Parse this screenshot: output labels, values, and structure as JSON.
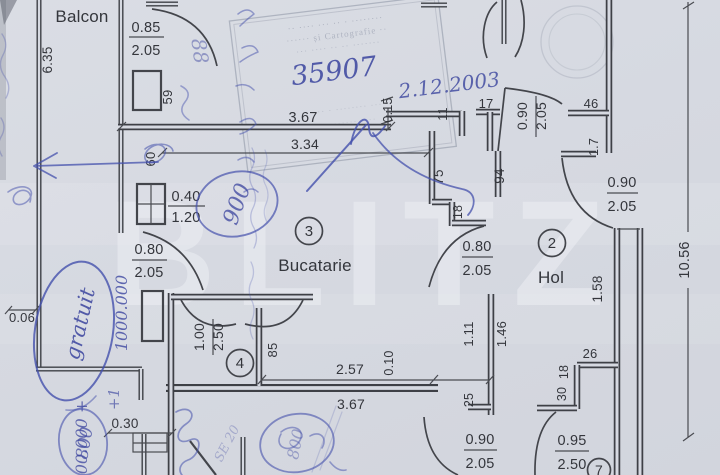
{
  "colors": {
    "paper": "#d6d9e1",
    "ink": "#3b3d43",
    "pen_blue": "#4450ac"
  },
  "watermark": "BLITZ",
  "rooms": {
    "balcony_label": "Balcon",
    "kitchen_no": "3",
    "kitchen_label": "Bucatarie",
    "hall_no": "2",
    "hall_label": "Hol",
    "storage_no": "4",
    "room7_no": "7"
  },
  "doors": {
    "balcony_door": {
      "w": "0.85",
      "h": "2.05"
    },
    "kitchen_window": {
      "w": "0.40",
      "h": "1.20"
    },
    "balcony_lower_door": {
      "w": "0.80",
      "h": "2.05"
    },
    "kitchen_hall_door": {
      "w": "0.80",
      "h": "2.05"
    },
    "entry_door": {
      "w": "0.90",
      "h": "2.05"
    },
    "hall_right_door": {
      "w": "0.90",
      "h": "2.05"
    },
    "storage_door": {
      "w": "1.00",
      "h": "2.50"
    },
    "bottom_door": {
      "w": "0.90",
      "h": "2.05"
    },
    "bottom_right_door": {
      "w": "0.95",
      "h": "2.50"
    }
  },
  "dims": {
    "balcony_len": "6.35",
    "pier": "59",
    "kitchen_out": "3.67",
    "step015": "0.15",
    "n11": "11",
    "n17": "17",
    "n46": "46",
    "n17b": "1.7",
    "kitchen_in": "3.34",
    "n60": "60",
    "n75": "75",
    "n94": "94",
    "n18": "18",
    "n18b": "18",
    "hall_total": "10.56",
    "n158": "1.58",
    "n85": "85",
    "n257": "2.57",
    "n010": "0.10",
    "bottom": "3.67",
    "n111": "1.11",
    "n146": "1.46",
    "n25": "25",
    "n26": "26",
    "n30": "30",
    "n006": "0.06",
    "n030": "0.30"
  },
  "stamp": {
    "number": "35907",
    "date": "2.12.2003",
    "rows": [
      "·· ···· ··· ·· · ········",
      "······ și Cartografie ··",
      "··· ···· ·· ·· ·······",
      "···· · ········ ···",
      "·· ······· ····"
    ]
  },
  "pen": {
    "gratuit": "gratuit",
    "amount_1": "1000.000",
    "amount_2": "00.000 +",
    "plus1": "+1",
    "circled_left": "800",
    "circled_right": "800",
    "doodle": "88",
    "circled_mid": "900",
    "faint_diag": "SE 20"
  }
}
